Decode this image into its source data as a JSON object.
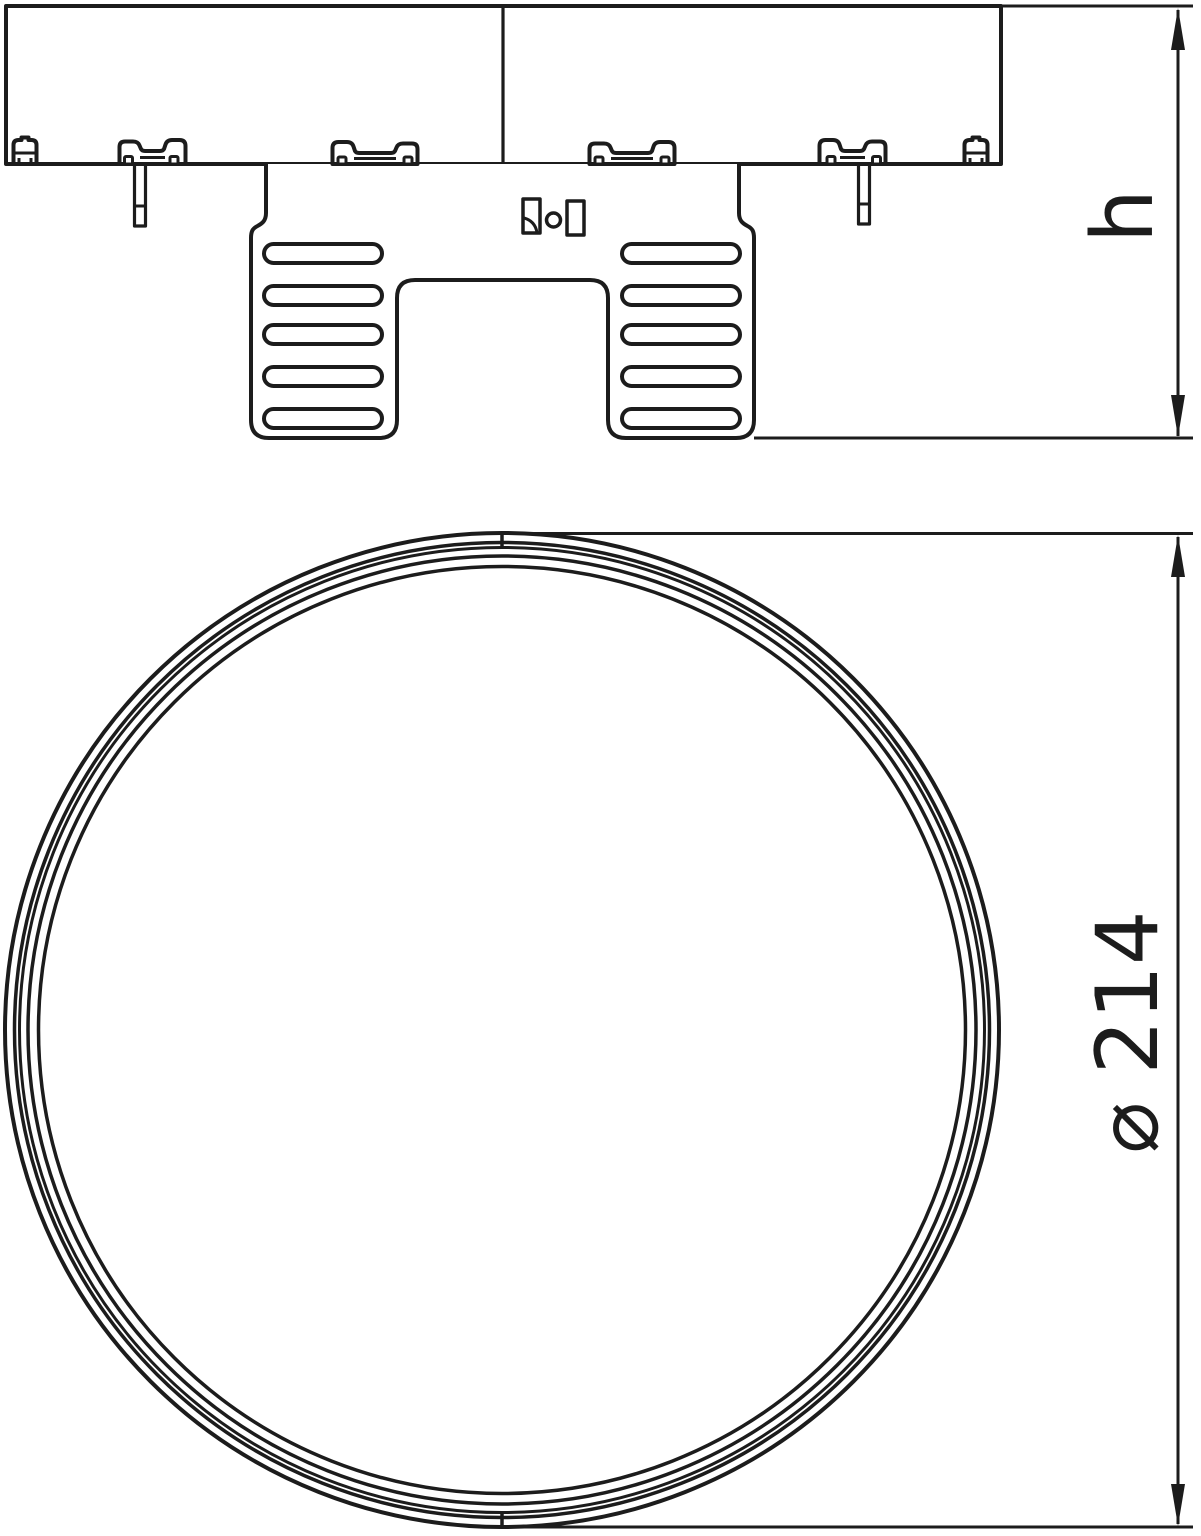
{
  "drawing": {
    "background_color": "#ffffff",
    "line_color": "#1c1c1c",
    "dimensions": {
      "height_label": "h",
      "diameter_label": "⌀ 214"
    }
  }
}
